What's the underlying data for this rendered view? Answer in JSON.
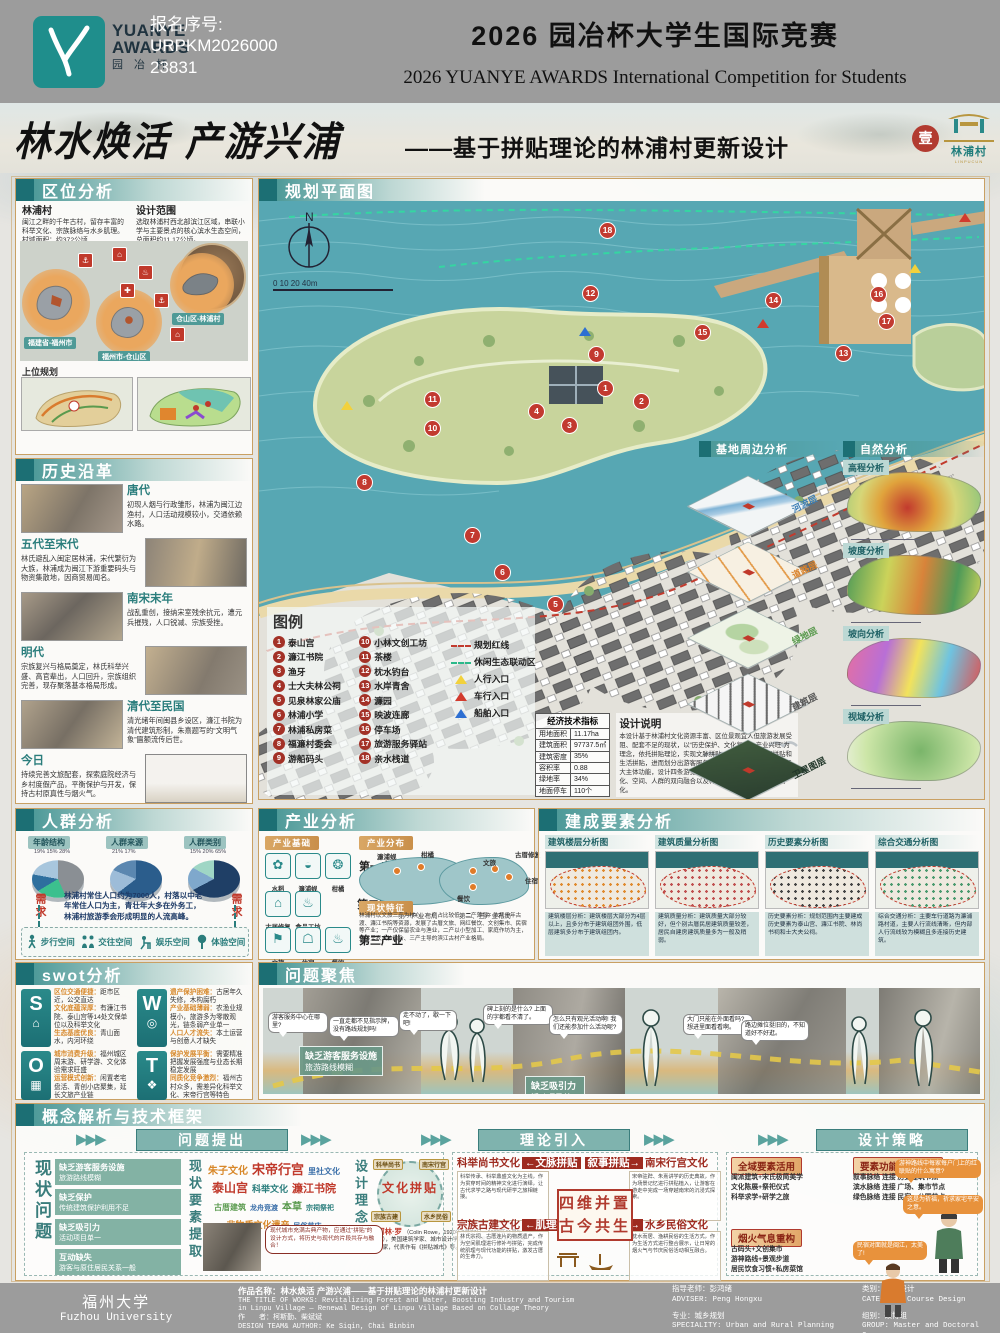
{
  "header": {
    "logo": {
      "line1": "YUANYE",
      "line2": "AWARDS",
      "line3": "园 冶 杯"
    },
    "reg_label": "报名序号:",
    "reg_line1": "URPKM2026000",
    "reg_line2": "23831",
    "title": "2026 园冶杯大学生国际竞赛",
    "subtitle": "2026 YUANYE AWARDS International Competition for  Students"
  },
  "title_band": {
    "calligraphy": "林水焕活 产游兴浦",
    "dash_subtitle": "——基于拼贴理论的林浦村更新设计",
    "seal": "壹",
    "village_badge": "林浦村",
    "village_badge_en": "LINPUCUN"
  },
  "location": {
    "heading": "区位分析",
    "village_title": "林浦村",
    "village_text": "闽江之畔的千年古村，留存丰富的科举文化、宗族脉络与水乡肌理。村域面积：约372公顷",
    "scope_title": "设计范围",
    "scope_text": "选取林浦村西北部滨江区域，串联小学与主要景点的核心滨水生态空间，总面积约11.17公顷。",
    "map_labels": [
      {
        "t": "福建省-福州市",
        "x": 4,
        "y": 96
      },
      {
        "t": "福州市-仓山区",
        "x": 78,
        "y": 110
      },
      {
        "t": "仓山区-林浦村",
        "x": 152,
        "y": 72
      }
    ],
    "upper_title": "上位规划"
  },
  "history": {
    "heading": "历史沿革",
    "entries": [
      {
        "era": "唐代",
        "text": "初现人烟与行政雏形，林浦为闽江边渔村，人口活动规模较小，交通依赖水路。",
        "side": "L",
        "ph": "p1"
      },
      {
        "era": "五代至宋代",
        "text": "林氏避乱入闽定居林浦，宋代繁衍为大族，林浦成为闽江下游重要码头与物资集散地，因商贸易闻名。",
        "side": "R",
        "ph": "p2"
      },
      {
        "era": "南宋末年",
        "text": "战乱重创，接纳宋室残余抗元，遭元兵摧残，人口锐减、宗族受挫。",
        "side": "L",
        "ph": "p3"
      },
      {
        "era": "明代",
        "text": "宗族复兴与格局奠定，林氏科举兴盛、高官辈出，人口回升，宗族组织完善，现存聚落基本格局形成。",
        "side": "R",
        "ph": "p4"
      },
      {
        "era": "清代至民国",
        "text": "清光绪年间闽县乡设区，濂江书院为清代建筑形制，朱熹题写的“文明气象”匾额流传后世。",
        "side": "L",
        "ph": "p5"
      },
      {
        "era": "今日",
        "text": "持续完善文旅配套，探索庭院经济与乡村度假产品，平衡保护与开发，保持古村原真性与烟火气。",
        "side": "R",
        "ph": "p6"
      }
    ]
  },
  "people": {
    "heading": "人群分析",
    "charts": [
      {
        "label": "年龄结构",
        "pcts": "19%  15%  28%",
        "gradient": "conic-gradient(#8a8f94 0 45%, #3cc08e 45% 64%, #2e6f9e 64% 79%, #a8c6dd 79% 100%)"
      },
      {
        "label": "人群来源",
        "pcts": "21%  17%",
        "gradient": "conic-gradient(#2b5d8c 0 62%, #9dbcd8 62% 83%, #5b87b0 83% 100%)"
      },
      {
        "label": "人群类别",
        "pcts": "15%  20%  65%",
        "gradient": "conic-gradient(#1f3f66 0 65%, #7fa8cc 65% 85%, #9fd6c5 85% 100%)"
      }
    ],
    "demand": "需求",
    "desc": "林浦村常住人口约为7000人，村落以中老年常住人口为主，青壮年大多在外务工，林浦村旅游季会形成明显的人流高峰。",
    "spaces": [
      "步行空间",
      "交往空间",
      "娱乐空间",
      "体验空间"
    ]
  },
  "swot": {
    "heading": "swot分析",
    "s": {
      "letter": "S",
      "glyph": "⌂",
      "items": [
        {
          "lead": "区位交通便捷：",
          "body": "距市区近，公交直达"
        },
        {
          "lead": "文化底蕴深厚：",
          "body": "有濂江书院、泰山宫等14处文保单位以及科举文化"
        },
        {
          "lead": "生态基底优良：",
          "body": "青山面水，内河环绕"
        }
      ]
    },
    "w": {
      "letter": "W",
      "glyph": "◎",
      "items": [
        {
          "lead": "遗产保护困难：",
          "body": "古居年久失修，木构腐朽"
        },
        {
          "lead": "产业基础薄弱：",
          "body": "农渔业规模小，旅游多为零散观光，链条弱产业单一"
        },
        {
          "lead": "人口人才流失：",
          "body": "本土运营与创意人才缺失"
        }
      ]
    },
    "o": {
      "letter": "O",
      "glyph": "▦",
      "items": [
        {
          "lead": "城市消费升级：",
          "body": "福州城区周末游、研学游、文化体验需求旺盛"
        },
        {
          "lead": "运营模式创新：",
          "body": "闲置老宅盘活、青创小店聚集，延长文旅产业链"
        }
      ]
    },
    "t": {
      "letter": "T",
      "glyph": "❖",
      "items": [
        {
          "lead": "保护发展平衡：",
          "body": "需要精准把握发展强度与业态长期稳定发展"
        },
        {
          "lead": "同质化竞争激烈：",
          "body": "福州古村众多，需差异化科举文化、宋帝行宫等特色"
        }
      ]
    }
  },
  "plan": {
    "heading": "规划平面图",
    "north": "N",
    "scale": "0   10   20            40m",
    "legend_title": "图例",
    "legend_col1": [
      {
        "n": "1",
        "label": "泰山宫"
      },
      {
        "n": "2",
        "label": "濂江书院"
      },
      {
        "n": "3",
        "label": "渔牙"
      },
      {
        "n": "4",
        "label": "士大夫林公祠"
      },
      {
        "n": "5",
        "label": "见泉林家公庙"
      },
      {
        "n": "6",
        "label": "林浦小学"
      },
      {
        "n": "7",
        "label": "林浦私房菜"
      },
      {
        "n": "8",
        "label": "福濂村委会"
      },
      {
        "n": "9",
        "label": "游船码头"
      }
    ],
    "legend_col2": [
      {
        "n": "10",
        "label": "小林文创工坊"
      },
      {
        "n": "11",
        "label": "茶楼"
      },
      {
        "n": "12",
        "label": "枕水钓台"
      },
      {
        "n": "13",
        "label": "水岸青舍"
      },
      {
        "n": "14",
        "label": "濂园"
      },
      {
        "n": "15",
        "label": "映波连廊"
      },
      {
        "n": "16",
        "label": "停车场"
      },
      {
        "n": "17",
        "label": "旅游服务驿站"
      },
      {
        "n": "18",
        "label": "亲水栈道"
      }
    ],
    "legend_lines": [
      {
        "label": "规划红线",
        "cls": "red-dash"
      },
      {
        "label": "休闲生态联动区",
        "cls": "green-dash"
      },
      {
        "label": "人行入口",
        "cls": "tri-y"
      },
      {
        "label": "车行入口",
        "cls": "tri-r"
      },
      {
        "label": "船舶入口",
        "cls": "tri-b"
      }
    ],
    "markers": [
      {
        "n": "18",
        "x": 347,
        "y": 50
      },
      {
        "n": "12",
        "x": 330,
        "y": 113
      },
      {
        "n": "9",
        "x": 336,
        "y": 174
      },
      {
        "n": "1",
        "x": 345,
        "y": 208
      },
      {
        "n": "2",
        "x": 381,
        "y": 221
      },
      {
        "n": "4",
        "x": 276,
        "y": 231
      },
      {
        "n": "3",
        "x": 309,
        "y": 245
      },
      {
        "n": "11",
        "x": 172,
        "y": 219
      },
      {
        "n": "10",
        "x": 172,
        "y": 248
      },
      {
        "n": "8",
        "x": 104,
        "y": 302
      },
      {
        "n": "7",
        "x": 212,
        "y": 355
      },
      {
        "n": "6",
        "x": 242,
        "y": 392
      },
      {
        "n": "5",
        "x": 295,
        "y": 424
      },
      {
        "n": "14",
        "x": 513,
        "y": 120
      },
      {
        "n": "16",
        "x": 618,
        "y": 114
      },
      {
        "n": "17",
        "x": 626,
        "y": 141
      },
      {
        "n": "13",
        "x": 583,
        "y": 173
      },
      {
        "n": "15",
        "x": 442,
        "y": 152
      }
    ],
    "tris": [
      {
        "cls": "tri-y",
        "x": 82,
        "y": 222
      },
      {
        "cls": "tri-y",
        "x": 650,
        "y": 85
      },
      {
        "cls": "tri-r",
        "x": 700,
        "y": 34
      },
      {
        "cls": "tri-r",
        "x": 498,
        "y": 140
      },
      {
        "cls": "tri-b",
        "x": 320,
        "y": 148
      }
    ],
    "indicators": {
      "title": "经济技术指标",
      "rows": [
        {
          "k": "用地面积",
          "v": "11.17ha"
        },
        {
          "k": "建筑面积",
          "v": "97737.5㎡"
        },
        {
          "k": "建筑密度",
          "v": "35%"
        },
        {
          "k": "容积率",
          "v": "0.88"
        },
        {
          "k": "绿地率",
          "v": "34%"
        },
        {
          "k": "地面停车",
          "v": "110个"
        }
      ]
    },
    "notes_title": "设计说明",
    "notes": "本设计基于林浦村文化资源丰富、区位景观宜人但旅游发展受阻、配套不足的现状，以“历史保护、文化复兴、产业兴旺”为理念，依托拼贴理论，实现文脉拼贴、叙事拼贴、肌理拼贴和生活拼贴，进而划分出游客服务、休闲、体验、文创、研学五大主体功能，设计四条游览线路，联动游客与原住民，实现文化、空间、人群的双向融合以及林浦产业、文化、景观的活化。"
  },
  "surround": {
    "heading": "基地周边分析",
    "layers": [
      {
        "label": "河流层",
        "c": "#3a7db5",
        "bg": "linear-gradient(115deg,#f2f5f6 38%,#7fb3d6 44%,#a9cce4 54%,#f2f5f6 60%)"
      },
      {
        "label": "道路层",
        "c": "#d9822b",
        "bg": "repeating-linear-gradient(25deg,#f7f0e2 0 11px,#e39b4a 11px 13px,#f7f0e2 13px 26px)"
      },
      {
        "label": "绿地层",
        "c": "#5a9a4e",
        "bg": "radial-gradient(circle at 35% 45%,#b5d4a2 0 22%,rgba(0,0,0,0) 24%),radial-gradient(circle at 70% 60%,#cde0bb 0 18%,rgba(0,0,0,0) 20%),#eef3e6"
      },
      {
        "label": "建筑层",
        "c": "#555555",
        "bg": "repeating-linear-gradient(45deg,#f5f5f5 0 5px,#6a6a6a 5px 7px,#f5f5f5 7px 12px)"
      },
      {
        "label": "卫星图层",
        "c": "#22372a",
        "bg": "linear-gradient(120deg,#3f5a3d,#2c4030)"
      }
    ]
  },
  "nature": {
    "heading": "自然分析",
    "maps": [
      {
        "label": "高程分析",
        "grad": "radial-gradient(circle at 45% 60%,#c23a2e,#e0a33c 35%,#d6d678 60%,#9cc87a 90%)"
      },
      {
        "label": "坡度分析",
        "grad": "linear-gradient(100deg,#4f9a58,#cbd35a 30%,#d8833a 55%,#4f9a58 80%,#cbd35a)"
      },
      {
        "label": "坡向分析",
        "grad": "linear-gradient(105deg,#e66fa0,#b86fd6 28%,#f2e25c 50%,#6fc3e0 72%,#e05050)"
      },
      {
        "label": "视域分析",
        "grad": "radial-gradient(circle at 55% 50%,#7ab56a,#cde6a8 70%,#e8f0d8)"
      }
    ]
  },
  "industry": {
    "heading": "产业分析",
    "base_label": "产业基础",
    "dist_label": "产业分布",
    "status_label": "现状特征",
    "label1": "第一产业",
    "label2": "第二产业",
    "label3": "第三产业",
    "r1": [
      {
        "g": "✿",
        "label": "水稻"
      },
      {
        "g": "◒",
        "label": "濂浦蚬"
      },
      {
        "g": "❂",
        "label": "柑橘"
      }
    ],
    "r2": [
      {
        "g": "⌂",
        "label": "古居修复"
      },
      {
        "g": "♨",
        "label": "食品工坊"
      }
    ],
    "r3": [
      {
        "g": "⚑",
        "label": "文旅"
      },
      {
        "g": "☖",
        "label": "住宿"
      },
      {
        "g": "♨",
        "label": "餐饮"
      }
    ],
    "map1_caption": "第一产业布局",
    "map2_caption": "第二、三产业布局",
    "map1_tags": [
      {
        "t": "濂浦蚬",
        "x": 18,
        "y": 2
      },
      {
        "t": "柑橘",
        "x": 62,
        "y": 0
      }
    ],
    "map2_tags": [
      {
        "t": "古厝修复",
        "x": 76,
        "y": 0
      },
      {
        "t": "文旅",
        "x": 44,
        "y": 8
      },
      {
        "t": "住宿",
        "x": 86,
        "y": 26
      },
      {
        "t": "餐饮",
        "x": 18,
        "y": 44
      }
    ],
    "status_text": "林浦村以文旅三产为核心，一产占比较低、二产薄弱。依托千年古渡、濂江书院等资源，发展了古厝文旅、网红餐饮、文创集市、民宿等产业；一产仅保留农业与渔业，二产以小型加工、家庭作坊为主，整体呈农文旅融合、三产主导的滨江古村产业格局。"
  },
  "built": {
    "heading": "建成要素分析",
    "panels": [
      {
        "title": "建筑楼层分析图",
        "dots": "#e08a2e",
        "caption": "建筑楼层分析：建筑楼层大部分为4层以上，且多分布于建筑组团外围，低层建筑多分布于建筑组团内。"
      },
      {
        "title": "建筑质量分析图",
        "dots": "#c05050",
        "caption": "建筑质量分析：建筑质量大部分较好，但个别古厝民居建筑质量较差，居民自建房建筑质量多为一般及稍弱。"
      },
      {
        "title": "历史要素分析图",
        "dots": "#444444",
        "caption": "历史要素分析：规划范围内主要建成历史要素为泰山宫、濂江书院、林尚书祠和士大夫公祠。"
      },
      {
        "title": "综合交通分析图",
        "dots": "#4a9a6e",
        "caption": "综合交通分析：主要车行道路为濂浦路村道，主要人行流线清晰，但内部人行流线较为模糊且多连接历史建筑。"
      }
    ]
  },
  "problems": {
    "heading": "问题聚焦",
    "labels": [
      {
        "t1": "缺乏游客服务设施",
        "t2": "旅游路线模糊",
        "x": 36,
        "y": 58
      },
      {
        "t1": "缺乏保护",
        "t2": "传统建筑保护利用不足",
        "x": 100,
        "y": 110
      },
      {
        "t1": "缺乏吸引力",
        "t2": "活动项目单一",
        "x": 262,
        "y": 88
      },
      {
        "t1": "互动缺失",
        "t2": "游客与原住居民关系一般",
        "x": 384,
        "y": 118
      }
    ],
    "bubbles": [
      {
        "t": "游客服务中心在哪里?",
        "x": 5,
        "y": 24,
        "w": 52
      },
      {
        "t": "一直走都不见指示牌，没有路线规划吗!",
        "x": 66,
        "y": 28,
        "w": 62
      },
      {
        "t": "走不动了，歇一下吧!",
        "x": 136,
        "y": 22,
        "w": 50
      },
      {
        "t": "碑上刻的是什么? 上面的字都看不清了。",
        "x": 220,
        "y": 16,
        "w": 62
      },
      {
        "t": "怎么只有观光活动啊! 我们还能参加什么活动呢?",
        "x": 286,
        "y": 26,
        "w": 66
      },
      {
        "t": "大门只能在外面看吗? 想进里面看看啊。",
        "x": 420,
        "y": 26,
        "w": 62
      },
      {
        "t": "路边摊位挺旧的，不知道好不好逛。",
        "x": 478,
        "y": 32,
        "w": 60
      }
    ]
  },
  "framework": {
    "heading": "概念解析与技术框架",
    "step1": "问题提出",
    "step2": "理论引入",
    "step3": "设计策略",
    "v1": "现状问题",
    "v2": "现状要素提取",
    "v3": "设计理念",
    "problems": [
      {
        "t1": "缺乏游客服务设施",
        "t2": "旅游路线模糊"
      },
      {
        "t1": "缺乏保护",
        "t2": "传统建筑保护利用不足"
      },
      {
        "t1": "缺乏吸引力",
        "t2": "活动项目单一"
      },
      {
        "t1": "互动缺失",
        "t2": "游客与原住居民关系一般"
      }
    ],
    "cloud": [
      {
        "t": "朱子文化",
        "c": "#d8882a",
        "s": 10
      },
      {
        "t": "宋帝行宫",
        "c": "#c0392b",
        "s": 13
      },
      {
        "t": "里社文化",
        "c": "#3a6ea8",
        "s": 8
      },
      {
        "t": "泰山宫",
        "c": "#c0392b",
        "s": 12
      },
      {
        "t": "科举文化",
        "c": "#2a7d7c",
        "s": 9
      },
      {
        "t": "濂江书院",
        "c": "#c0392b",
        "s": 11
      },
      {
        "t": "古厝建筑",
        "c": "#5a9a4e",
        "s": 8
      },
      {
        "t": "龙舟竞渡",
        "c": "#3a6ea8",
        "s": 7
      },
      {
        "t": "本草",
        "c": "#5a9a4e",
        "s": 10
      },
      {
        "t": "宗祠祭祀",
        "c": "#2a7d7c",
        "s": 7
      },
      {
        "t": "非物质文化遗产",
        "c": "#d8882a",
        "s": 9
      },
      {
        "t": "民俗节庆",
        "c": "#3a6ea8",
        "s": 7
      }
    ],
    "collage": "文化拼贴",
    "sats": [
      {
        "t": "科举尚书",
        "x": -6,
        "y": -4
      },
      {
        "t": "南宋行宫",
        "x": 40,
        "y": -4
      },
      {
        "t": "宗族古建",
        "x": -8,
        "y": 48
      },
      {
        "t": "水乡民俗",
        "x": 42,
        "y": 48
      }
    ],
    "rowe_name": "柯林·罗",
    "rowe_text": "（Colin Rowe，1920年3月27日—1999年11月5日），美国建筑学家、城市设计学家、历史学家、教育家、理论家，代表作有《拼贴城市》等。",
    "rowe_quote": "现代城市充满古典产物，应通过“拼贴”的设计方式，将历史与现代的片段共存与融合！",
    "theory": {
      "l1a": "科举尚书文化",
      "l1k1": "←文脉拼贴",
      "l1k2": "叙事拼贴→",
      "l1b": "南宋行宫文化",
      "c1": "四维并置",
      "c2": "古今共生",
      "l2a": "宗族古建文化",
      "l2k1": "←肌理拼贴",
      "l2k2": "生活拼贴→",
      "l2b": "水乡民俗文化",
      "paras": [
        "科举传承、科举鼎盛文化为主线，作为贯穿时间的精神文化进行演绎，让古代求学之路与现代研学之旅相链接。",
        "宋帝驻跸、朱熹讲学的历史典故，作为场景记忆进行拼贴植入，让游客在游走中完成一场穿越南宋的沉浸式探索。",
        "林氏宗祠、古厝连片的物质遗产，作为空间肌理进行修补与拼贴，完成传统肌理与现代功能的拼贴，激发古厝的生命力。",
        "枕水而居、渔耕民俗的生活方式，作为生活方式进行整合展示，让日常的烟火气与节庆民俗活动相互融合。"
      ]
    },
    "strategy": {
      "s1": "全域要素活用",
      "s1_items": [
        "闽派建筑+宋氏极简美学",
        "文化陈展+祭祀仪式",
        "科举求学+研学之旅"
      ],
      "s2": "要素功能兼容拼贴",
      "s2_items": [
        "叙事脉络 连接 历史建筑节点",
        "滨水脉络 连接 广场、集市节点",
        "绿色脉络 连接 民宿、公园节点"
      ],
      "s3": "烟火气息重构",
      "s3_items": [
        "古码头+文创集市",
        "游神路线+景观步道",
        "居民饮食习惯+私房菜馆"
      ],
      "bubbles": [
        {
          "t": "游神路线中每家每户门上的红联贴的什么寓意?",
          "x": 168,
          "y": 6,
          "w": 78
        },
        {
          "t": "这是为祈福，祈求家宅平安之意。",
          "x": 176,
          "y": 42,
          "w": 72
        },
        {
          "t": "民宿对面就是闽江，太美了!",
          "x": 126,
          "y": 88,
          "w": 66
        }
      ]
    }
  },
  "footer": {
    "uni_cn": "福州大学",
    "uni_en": "Fuzhou University",
    "title_cn": "作品名称：林水焕活 产游兴浦——基于拼贴理论的林浦村更新设计",
    "title_en1": "THE TITLE OF WORKS: Revitalizing Forest and Water, Boosting Industry and Tourism",
    "title_en2": "in Linpu Village — Renewal Design of Linpu Village Based on Collage Theory",
    "author_cn": "作　　者：柯斯勤、柴斌斌",
    "author_en": "DESIGN TEAM& AUTHOR: Ke Siqin, Chai Binbin",
    "adviser_cn": "指导老师：彭鸿绪",
    "adviser_en": "ADVISER: Peng Hongxu",
    "major_cn": "专业：城乡规划",
    "major_en": "SPECIALITY: Urban and Rural Planning",
    "cat_cn": "类别：课程设计",
    "cat_en": "CATEGORY: Course Design",
    "group_cn": "组别：硕博组",
    "group_en": "GROUP: Master and Doctoral Group"
  }
}
